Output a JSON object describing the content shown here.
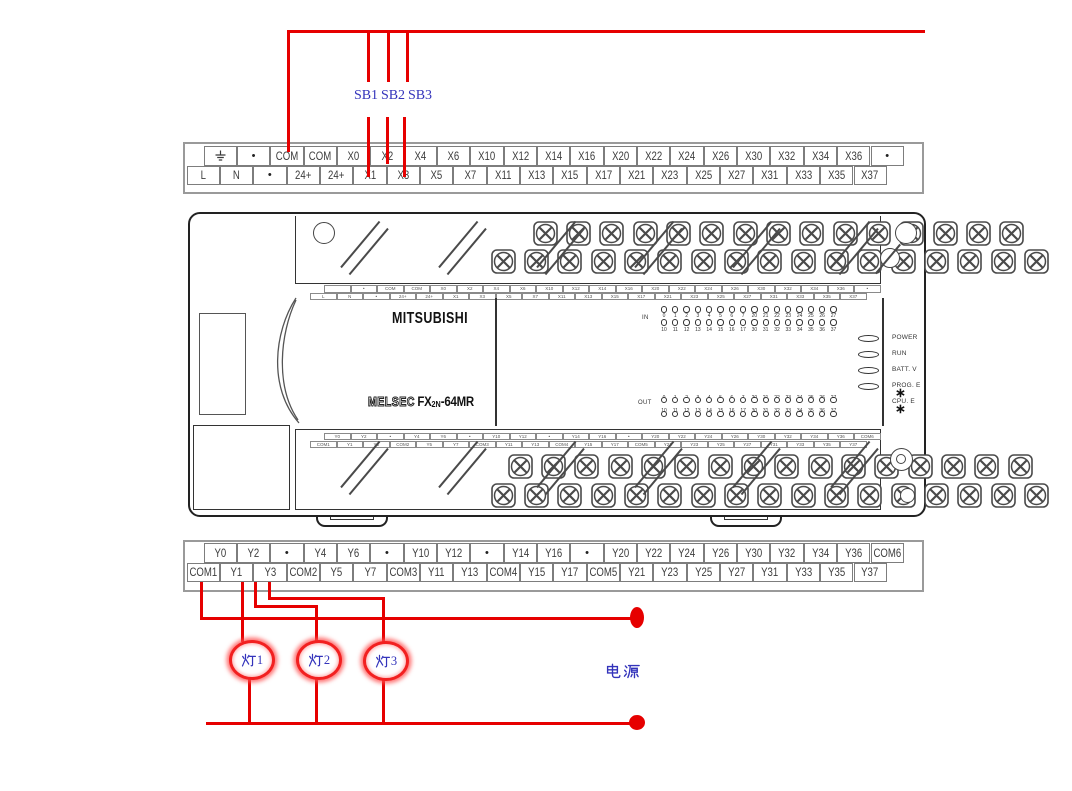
{
  "colors": {
    "wire_red": "#e60000",
    "annotation_blue": "#3333bb",
    "line_dark": "#333333",
    "cell_border": "#7d7d7d"
  },
  "annotations": {
    "push_buttons": [
      "SB1",
      "SB2",
      "SB3"
    ],
    "lamps": [
      "灯1",
      "灯2",
      "灯3"
    ],
    "power_supply": "电源"
  },
  "input_terminal_strip": {
    "row1": [
      "⏚",
      "•",
      "COM",
      "COM",
      "X0",
      "X2",
      "X4",
      "X6",
      "X10",
      "X12",
      "X14",
      "X16",
      "X20",
      "X22",
      "X24",
      "X26",
      "X30",
      "X32",
      "X34",
      "X36",
      "•"
    ],
    "row2": [
      "L",
      "N",
      "•",
      "24+",
      "24+",
      "X1",
      "X3",
      "X5",
      "X7",
      "X11",
      "X13",
      "X15",
      "X17",
      "X21",
      "X23",
      "X25",
      "X27",
      "X31",
      "X33",
      "X35",
      "X37"
    ]
  },
  "output_terminal_strip": {
    "row1": [
      "Y0",
      "Y2",
      "•",
      "Y4",
      "Y6",
      "•",
      "Y10",
      "Y12",
      "•",
      "Y14",
      "Y16",
      "•",
      "Y20",
      "Y22",
      "Y24",
      "Y26",
      "Y30",
      "Y32",
      "Y34",
      "Y36",
      "COM6"
    ],
    "row2": [
      "COM1",
      "Y1",
      "Y3",
      "COM2",
      "Y5",
      "Y7",
      "COM3",
      "Y11",
      "Y13",
      "COM4",
      "Y15",
      "Y17",
      "COM5",
      "Y21",
      "Y23",
      "Y25",
      "Y27",
      "Y31",
      "Y33",
      "Y35",
      "Y37"
    ]
  },
  "plc": {
    "brand": "MITSUBISHI",
    "series": "MELSEC",
    "model_prefix": "FX",
    "model_subscript": "2N",
    "model_suffix": "-64MR",
    "in_label": "IN",
    "out_label": "OUT",
    "io_numbers": {
      "top": [
        "0",
        "1",
        "2",
        "3",
        "4",
        "5",
        "6",
        "7",
        "20",
        "21",
        "22",
        "23",
        "24",
        "25",
        "26",
        "27"
      ],
      "bottom": [
        "10",
        "11",
        "12",
        "13",
        "14",
        "15",
        "16",
        "17",
        "30",
        "31",
        "32",
        "33",
        "34",
        "35",
        "36",
        "37"
      ]
    },
    "status_leds": [
      "POWER",
      "RUN",
      "BATT. V",
      "PROG. E",
      "CPU. E"
    ]
  }
}
